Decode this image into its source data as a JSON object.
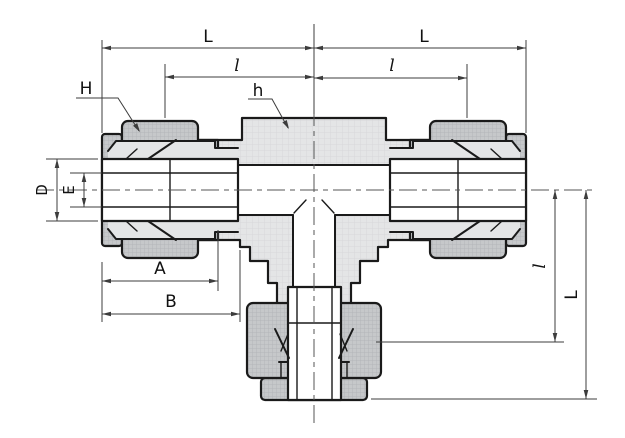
{
  "drawing": {
    "type": "engineering-cross-section",
    "subject": "union-tee-tube-fitting",
    "labels": {
      "overall_length_left": "L",
      "overall_length_right": "L",
      "insertion_length_left": "l",
      "insertion_length_right": "l",
      "nut_callout": "H",
      "body_callout": "h",
      "tube_outer_diameter": "D",
      "tube_inner_diameter": "E",
      "dim_a": "A",
      "dim_b": "B",
      "branch_insertion_length": "l",
      "branch_overall_length": "L"
    },
    "colors": {
      "background": "#ffffff",
      "outline": "#1a1a1a",
      "dim": "#3c3c3c",
      "body-fill": "#e4e5e6",
      "body-grid": "#d7d8da",
      "nut-fill": "#c6c8ca",
      "nut-grid": "#b4b6b9",
      "label": "#111111"
    }
  }
}
